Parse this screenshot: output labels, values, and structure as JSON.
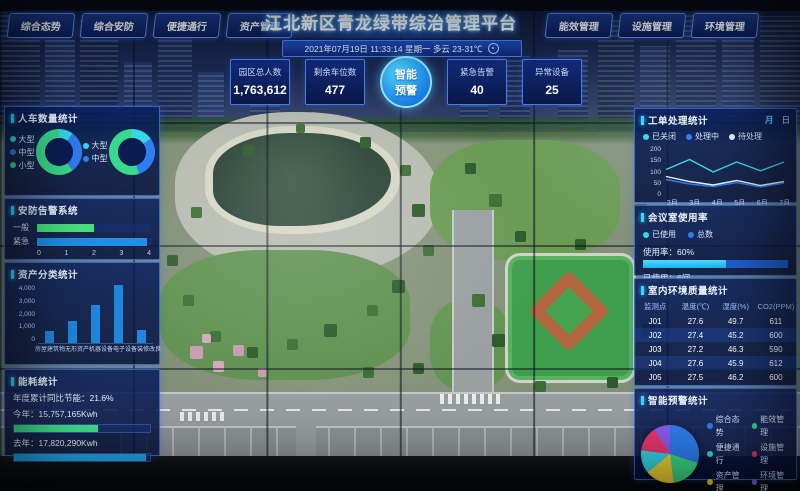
{
  "header": {
    "left_menu": [
      "综合态势",
      "综合安防",
      "便捷通行",
      "资产管理"
    ],
    "right_menu": [
      "能效管理",
      "设施管理",
      "环境管理"
    ],
    "title": "江北新区青龙绿带综治管理平台",
    "datetime": "2021年07月19日 11:33:14 星期一  多云 23-31℃"
  },
  "stats": {
    "badge": {
      "line1": "智能",
      "line2": "预警"
    },
    "items": [
      {
        "label": "园区总人数",
        "value": "1,763,612"
      },
      {
        "label": "剩余车位数",
        "value": "477"
      },
      {
        "label": "紧急告警",
        "value": "40"
      },
      {
        "label": "异常设备",
        "value": "25"
      }
    ]
  },
  "vehicle": {
    "title": "人车数量统计",
    "donut1": {
      "segments": [
        {
          "label": "大型",
          "color": "#35d6e8",
          "value": 10
        },
        {
          "label": "中型",
          "color": "#2f7df0",
          "value": 30
        },
        {
          "label": "小型",
          "color": "#38d98c",
          "value": 60
        }
      ],
      "legend_count": 3
    },
    "donut2": {
      "segments": [
        {
          "label": "大型",
          "color": "#35d6e8",
          "value": 15
        },
        {
          "label": "中型",
          "color": "#2f7df0",
          "value": 30
        },
        {
          "label": "小型",
          "color": "#38d98c",
          "value": 55
        }
      ],
      "legend_count": 2
    }
  },
  "security": {
    "title": "安防告警系统",
    "bars": [
      {
        "label": "一般",
        "value": 2.0,
        "color": "#49e07c"
      },
      {
        "label": "紧急",
        "value": 3.85,
        "color": "#1f8fe8"
      }
    ],
    "xmax": 4,
    "xticks": [
      "0",
      "1",
      "2",
      "3",
      "4"
    ]
  },
  "assets": {
    "title": "资产分类统计",
    "yticks": [
      "4,000",
      "3,000",
      "2,000",
      "1,000",
      "0"
    ],
    "ymax": 4000,
    "categories": [
      "房屋建筑物",
      "无形资产",
      "机器设备",
      "电子设备",
      "装修改良"
    ],
    "values": [
      800,
      1500,
      2600,
      4000,
      900
    ],
    "bar_color": "#1e86dd"
  },
  "energy": {
    "title": "能耗统计",
    "summary": "年度累计同比节能：21.6%",
    "rows": [
      {
        "label": "今年：15,757,165Kwh",
        "pct": 62,
        "color": "#3fe08a"
      },
      {
        "label": "去年：17,820,290Kwh",
        "pct": 97,
        "color": "#22a6e8"
      }
    ]
  },
  "workorder": {
    "title": "工单处理统计",
    "tabs": [
      "月",
      "日"
    ],
    "yticks": [
      "200",
      "150",
      "100",
      "50",
      "0"
    ],
    "ymax": 200,
    "x": [
      "2月",
      "3月",
      "4月",
      "5月",
      "6月",
      "7月"
    ],
    "series": [
      {
        "name": "已关闭",
        "color": "#3fd8f0",
        "values": [
          110,
          150,
          100,
          140,
          105,
          140
        ]
      },
      {
        "name": "处理中",
        "color": "#2f7df0",
        "values": [
          70,
          52,
          42,
          58,
          40,
          56
        ]
      },
      {
        "name": "待处理",
        "color": "#e8f2ff",
        "values": [
          82,
          62,
          48,
          66,
          46,
          62
        ]
      }
    ]
  },
  "meeting": {
    "title": "会议室使用率",
    "legend": [
      {
        "label": "已使用",
        "color": "#35d6e8"
      },
      {
        "label": "总数",
        "color": "#2f7df0"
      }
    ],
    "rate_label": "使用率：60%",
    "rate_pct": 57,
    "used_label": "已使用：6间"
  },
  "environment": {
    "title": "室内环境质量统计",
    "headers": [
      "监测点",
      "温度(℃)",
      "湿度(%)",
      "CO2(PPM)"
    ],
    "rows": [
      [
        "J01",
        "27.6",
        "49.7",
        "611"
      ],
      [
        "J02",
        "27.4",
        "45.2",
        "600"
      ],
      [
        "J03",
        "27.2",
        "46.3",
        "590"
      ],
      [
        "J04",
        "27.6",
        "45.9",
        "612"
      ],
      [
        "J05",
        "27.5",
        "46.2",
        "600"
      ]
    ]
  },
  "alerts": {
    "title": "智能预警统计",
    "pie": [
      {
        "color": "#2f7df0",
        "value": 30
      },
      {
        "color": "#3ddc84",
        "value": 18
      },
      {
        "color": "#f2d435",
        "value": 16
      },
      {
        "color": "#35d6e8",
        "value": 13
      },
      {
        "color": "#e8386e",
        "value": 14
      },
      {
        "color": "#8a5cf0",
        "value": 9
      }
    ],
    "legend": [
      {
        "label": "综合态势",
        "color": "#2f7df0"
      },
      {
        "label": "能效管理",
        "color": "#3ddc84"
      },
      {
        "label": "便捷通行",
        "color": "#35d6e8"
      },
      {
        "label": "设施管理",
        "color": "#e8386e"
      },
      {
        "label": "资产管理",
        "color": "#f2d435"
      },
      {
        "label": "环境管理",
        "color": "#8a5cf0"
      }
    ]
  }
}
